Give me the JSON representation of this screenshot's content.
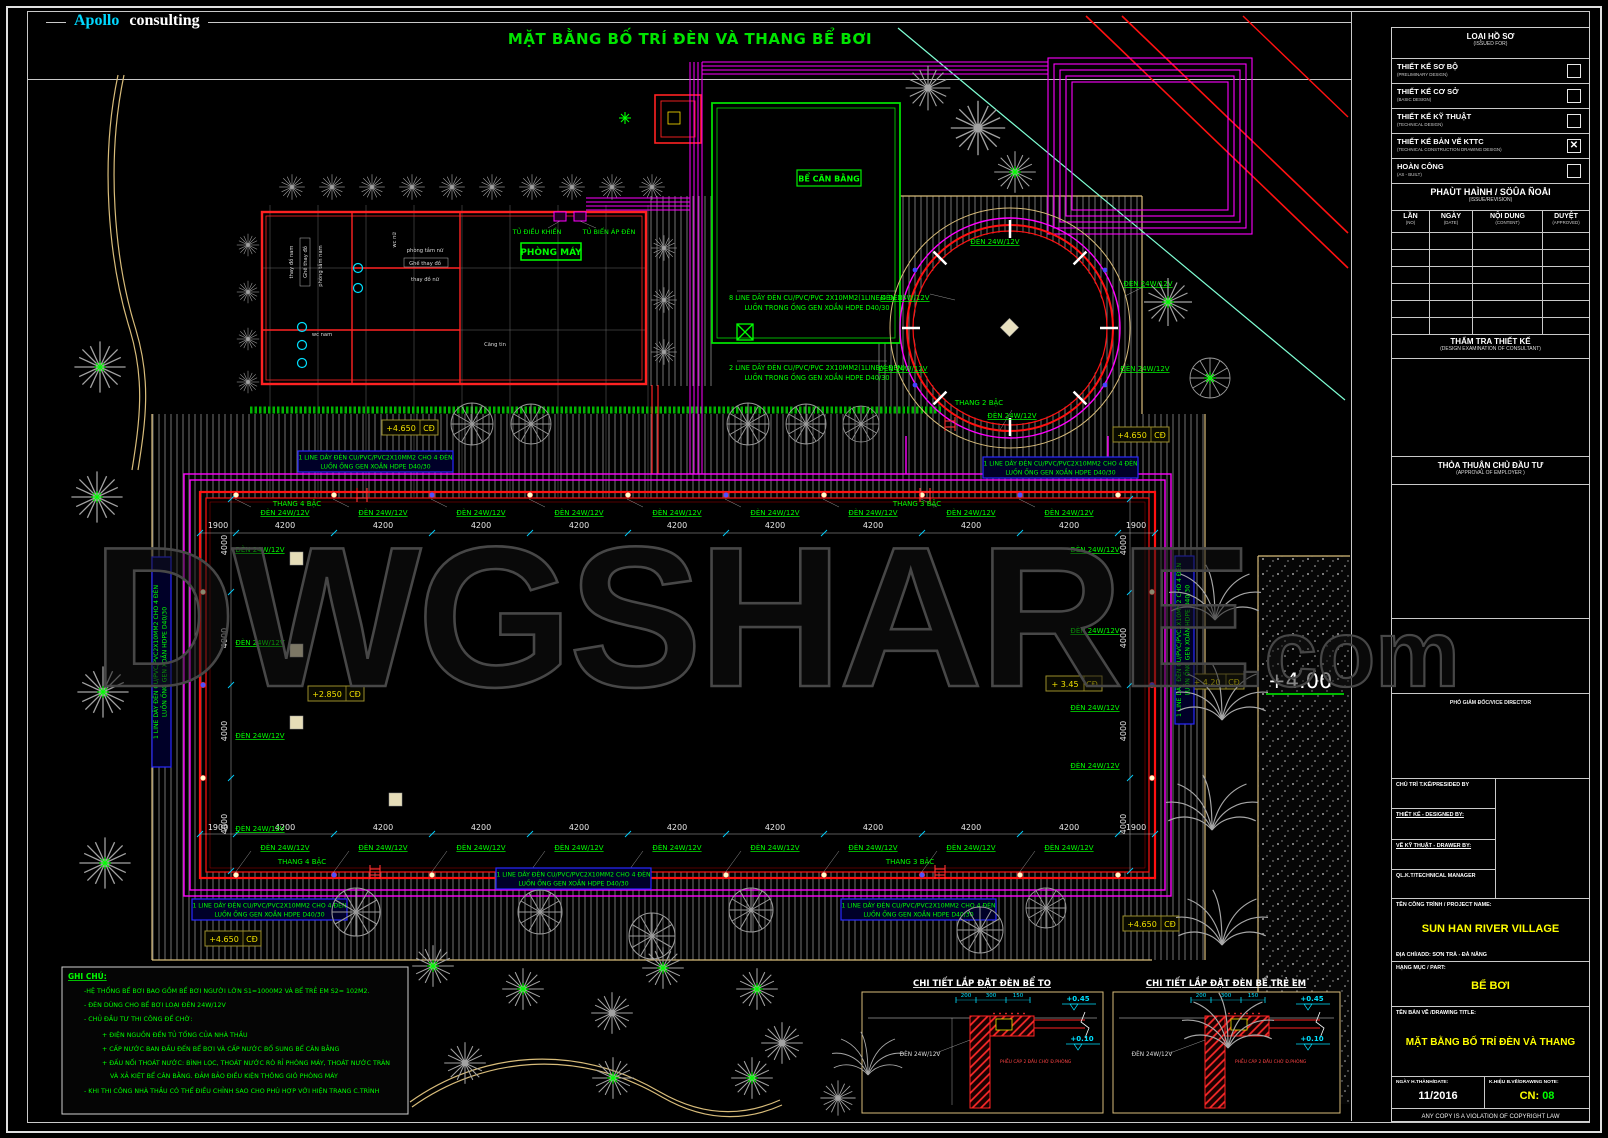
{
  "header": {
    "brand_a": "Apollo",
    "brand_b": "consulting",
    "title": "MẶT BẰNG BỐ TRÍ ĐÈN VÀ THANG BỂ BƠI"
  },
  "watermark": {
    "main": "DWGSHARE",
    "suffix": ".com"
  },
  "plan": {
    "den": "ĐÈN 24W/12V",
    "d4200": "4200",
    "d1900": "1900",
    "d4000": "4000",
    "thang_top_left": "THANG 4 BẬC",
    "thang_top_right": "THANG 3 BẬC",
    "thang_bottom_left": "THANG 4 BẬC",
    "thang_bottom_right": "THANG 3 BẬC",
    "thang_circle": "THANG 2 BẬC",
    "elev_4650": "+4.650",
    "elev_2850": "+2.850",
    "elev_345": "+ 3.45",
    "elev_420": "+ 4.20",
    "cd": "CĐ",
    "elev_400": "+4.00",
    "machine_room": "PHÒNG MÁY",
    "cab_control": "TỦ ĐIỀU KHIỂN",
    "cab_transformer": "TỦ BIẾN ÁP ĐÈN",
    "balance_tank": "BỂ CÂN BẰNG",
    "rooms": {
      "thay_do_nam": "thay đồ nam",
      "ghe_thay_do": "Ghế thay đồ",
      "phong_tam_nam": "phòng tắm nam",
      "wc_nu": "wc nữ",
      "phong_tam_nu": "phòng tắm nữ",
      "thay_do_nu": "thay đồ nữ",
      "wc_nam": "wc nam",
      "cang_tin": "Căng tin"
    },
    "note1_l1": "1 LINE DÂY ĐÈN CU/PVC/PVC2X10MM2 CHO 4 ĐÈN",
    "note1_l2": "LUỒN ỐNG GEN XOẮN HDPE D40/30",
    "note8_l1": "8 LINE DÂY ĐÈN CU/PVC/PVC 2X10MM2(1LINE/4 ĐÈN)",
    "note8_l2": "LUỒN TRONG ỐNG GEN XOẮN HDPE D40/30",
    "note2_l1": "2 LINE DÂY ĐÈN CU/PVC/PVC 2X10MM2(1LINE/4 ĐÈN)",
    "note2_l2": "LUỒN TRONG ỐNG GEN XOẮN HDPE D40/30"
  },
  "details": {
    "d1_title": "CHI TIẾT LẮP ĐẶT ĐÈN BỂ TO",
    "d2_title": "CHI TIẾT LẮP ĐẶT ĐÈN BỂ TRẺ EM",
    "elev_045": "+0.45",
    "elev_010": "+0.10",
    "dim_200": "200",
    "dim_300": "300",
    "dim_150": "150",
    "den": "ĐÈN 24W/12V",
    "funnel_note": "PHỄU CÁP 2 ĐẦU CHỜ Đ.PHÒNG"
  },
  "notes": {
    "title": "GHI CHÚ:",
    "l1": "-HỆ THỐNG BỂ BƠI BAO GỒM BỂ BƠI NGƯỜI LỚN S1=1000M2 VÀ BỂ TRẺ EM S2= 102M2.",
    "l2": "- ĐÈN DÙNG CHO BỂ BƠI LOẠI ĐÈN 24W/12V",
    "l3": "- CHỦ ĐẦU TƯ THI CÔNG ĐỂ CHỜ:",
    "l4": "+ ĐIỆN NGUỒN ĐẾN TỦ TỔNG CỦA NHÀ THẦU",
    "l5": "+ CẤP NƯỚC BAN ĐẦU ĐẾN BỂ BƠI VÀ CẤP NƯỚC BỔ SUNG BỂ CÂN BẰNG",
    "l6": "+ ĐẤU NỐI THOÁT NƯỚC: BÌNH LỌC, THOÁT NƯỚC RÒ RỈ PHÒNG MÁY, THOÁT NƯỚC TRÀN",
    "l7": "VÀ XẢ KIỆT BỂ CÂN BẰNG. ĐẢM BẢO ĐIỀU KIỆN THÔNG GIÓ PHÒNG MÁY",
    "l8": "- KHI THI CÔNG NHÀ THẦU CÓ THỂ ĐIỀU CHỈNH SAO CHO PHÙ HỢP VỚI HIỆN TRẠNG C.TRÌNH"
  },
  "titleblock": {
    "doc_type": "LOẠI HỒ SƠ",
    "doc_type_sub": "(ISSUED FOR)",
    "stages": [
      {
        "label": "THIẾT KẾ SƠ BỘ",
        "sub": "(PRELIMINARY DESIGN)",
        "mark": ""
      },
      {
        "label": "THIẾT KẾ CƠ SỞ",
        "sub": "(BASIC DESIGN)",
        "mark": ""
      },
      {
        "label": "THIẾT KẾ KỸ THUẬT",
        "sub": "(TECHNICAL DESIGN)",
        "mark": ""
      },
      {
        "label": "THIẾT KẾ BẢN VẼ KTTC",
        "sub": "(TECHNICAL CONSTRUCTION DRAWING DESIGN)",
        "mark": "✕"
      },
      {
        "label": "HOÀN CÔNG",
        "sub": "(AS - BUILT)",
        "mark": ""
      }
    ],
    "issue": "PHAÙT HAÌNH / SÖÛA ÑOÅI",
    "issue_sub": "(ISSUE/REVISION)",
    "rev_cols": [
      {
        "t": "LẦN",
        "s": "(NO)"
      },
      {
        "t": "NGÀY",
        "s": "(DATE)"
      },
      {
        "t": "NỘI DUNG",
        "s": "(CONTENT)"
      },
      {
        "t": "DUYỆT",
        "s": "(APPROVED)"
      }
    ],
    "exam": "THẨM TRA THIẾT KẾ",
    "exam_sub": "(DESIGN EXAMINATION OF CONSULTANT)",
    "approval": "THỎA THUẬN CHỦ ĐẦU TƯ",
    "approval_sub": "(APPROVAL OF EMPLOYER )",
    "vice": "PHÓ GIÁM ĐỐC/VICE DIRECTOR",
    "presided": "CHỦ TRÌ T.KẾ/PRESIDED BY",
    "designed": "THIẾT KẾ - DESIGNED BY:",
    "drawer": "VẼ KỸ THUẬT - DRAWER BY:",
    "manager": "QL.K.T/TECHNICAL MANAGER",
    "project_label": "TÊN CÔNG TRÌNH / PROJECT NAME:",
    "project_name": "SUN HAN RIVER VILLAGE",
    "address": "ĐỊA CHỈ/ADD: SƠN TRÀ - ĐÀ NẴNG",
    "part_label": "HẠNG MỤC / PART:",
    "part_name": "BỂ BƠI",
    "drawing_label": "TÊN BẢN VẼ /DRAWING TITLE:",
    "drawing_name": "MẶT BẰNG BỐ TRÍ ĐÈN VÀ THANG",
    "date_label": "NGÀY H.THÀNH/DATE:",
    "date_value": "11/2016",
    "code_label": "K.HIỆU B.VẼ/DRAWING NOTE:",
    "code_prefix": "CN:",
    "code_value": "08",
    "copyright": "ANY COPY IS A VIOLATION OF COPYRIGHT LAW"
  },
  "colors": {
    "accent_green": "#00ff00",
    "magenta": "#ff00ff",
    "red": "#ff2222",
    "cyan": "#00e0ff",
    "yellow": "#ffff00"
  }
}
